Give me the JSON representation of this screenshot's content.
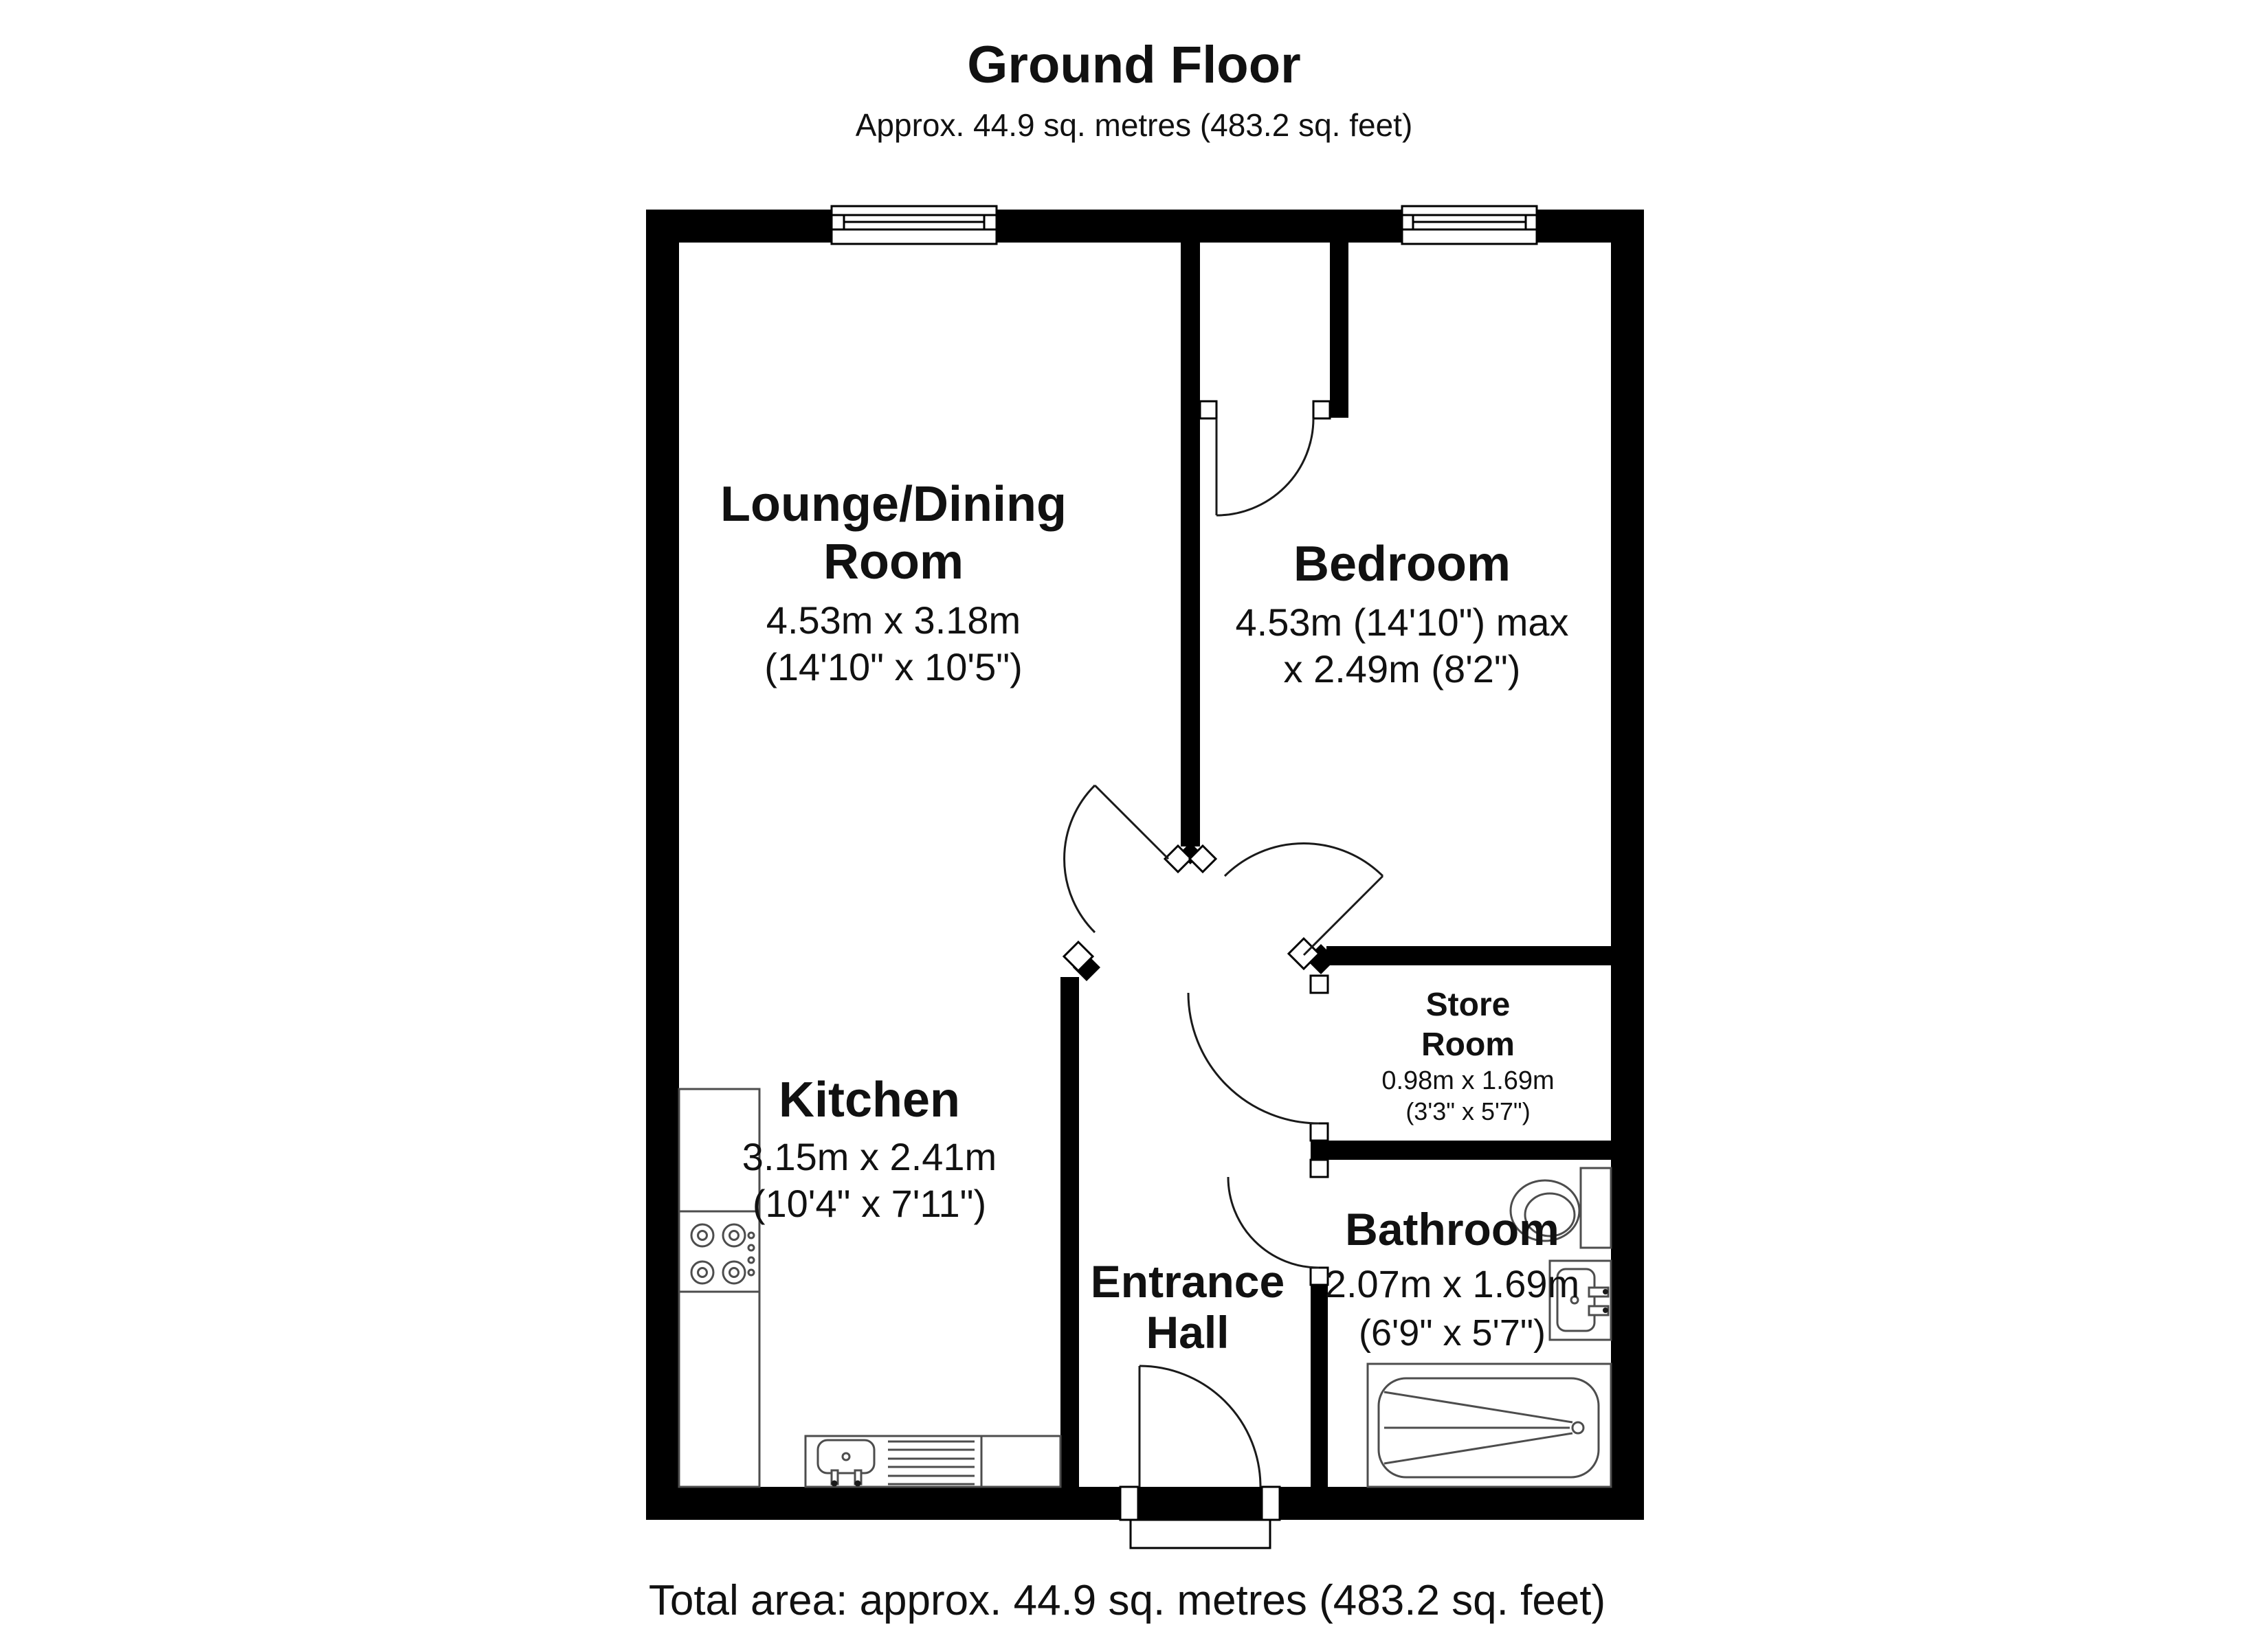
{
  "title": "Ground Floor",
  "subtitle": "Approx. 44.9 sq. metres (483.2 sq. feet)",
  "total_area": "Total area: approx. 44.9 sq. metres (483.2 sq. feet)",
  "rooms": {
    "lounge": {
      "name_line1": "Lounge/Dining",
      "name_line2": "Room",
      "dims_m": "4.53m x 3.18m",
      "dims_ft": "(14'10\" x 10'5\")"
    },
    "bedroom": {
      "name": "Bedroom",
      "dims_line1": "4.53m (14'10\") max",
      "dims_line2": "x 2.49m (8'2\")"
    },
    "kitchen": {
      "name": "Kitchen",
      "dims_m": "3.15m x 2.41m",
      "dims_ft": "(10'4\" x 7'11\")"
    },
    "store": {
      "name_line1": "Store",
      "name_line2": "Room",
      "dims_m": "0.98m x 1.69m",
      "dims_ft": "(3'3\" x 5'7\")"
    },
    "bathroom": {
      "name": "Bathroom",
      "dims_m": "2.07m x 1.69m",
      "dims_ft": "(6'9\" x 5'7\")"
    },
    "hall": {
      "name_line1": "Entrance",
      "name_line2": "Hall"
    }
  },
  "colors": {
    "wall": "#000000",
    "fixture": "#4d4d4d",
    "text": "#111111"
  }
}
